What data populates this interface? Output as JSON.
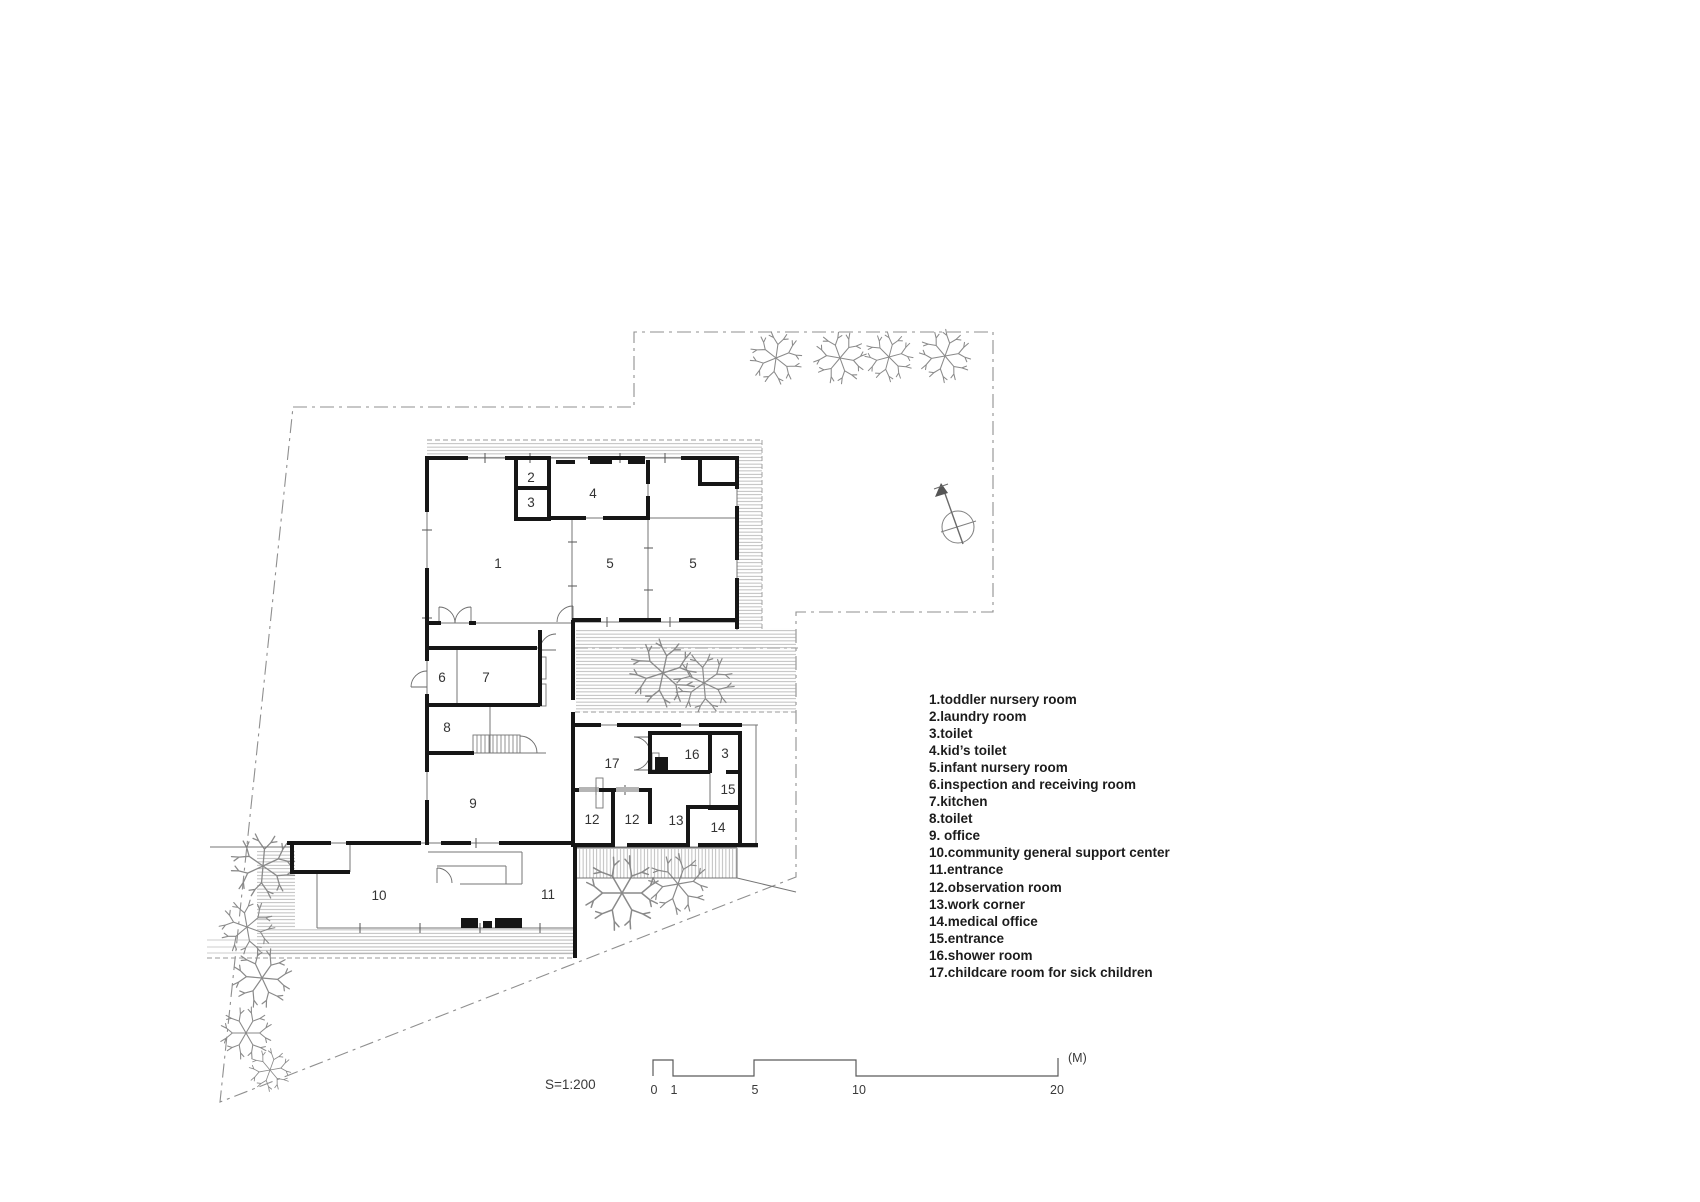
{
  "colors": {
    "wall": "#161616",
    "thin_line": "#757575",
    "hatch": "#a3a3a3",
    "boundary": "#8f8f8f",
    "text": "#333333"
  },
  "legend": {
    "items": [
      "1.toddler nursery room",
      "2.laundry room",
      "3.toilet",
      "4.kid’s toilet",
      "5.infant nursery room",
      "6.inspection and receiving room",
      "7.kitchen",
      "8.toilet",
      "9. office",
      "10.community general support center",
      "11.entrance",
      "12.observation room",
      "13.work corner",
      "14.medical office",
      "15.entrance",
      "16.shower room",
      "17.childcare room for sick children"
    ]
  },
  "rooms": [
    {
      "label": "1"
    },
    {
      "label": "2"
    },
    {
      "label": "3"
    },
    {
      "label": "4"
    },
    {
      "label": "5"
    },
    {
      "label": "5"
    },
    {
      "label": "6"
    },
    {
      "label": "7"
    },
    {
      "label": "8"
    },
    {
      "label": "9"
    },
    {
      "label": "10"
    },
    {
      "label": "11"
    },
    {
      "label": "12"
    },
    {
      "label": "12"
    },
    {
      "label": "13"
    },
    {
      "label": "14"
    },
    {
      "label": "15"
    },
    {
      "label": "16"
    },
    {
      "label": "3"
    },
    {
      "label": "17"
    }
  ],
  "scale": {
    "ratio": "S=1:200",
    "unit": "(M)",
    "ticks": [
      {
        "label": "0"
      },
      {
        "label": "1"
      },
      {
        "label": "5"
      },
      {
        "label": "10"
      },
      {
        "label": "20"
      }
    ]
  }
}
